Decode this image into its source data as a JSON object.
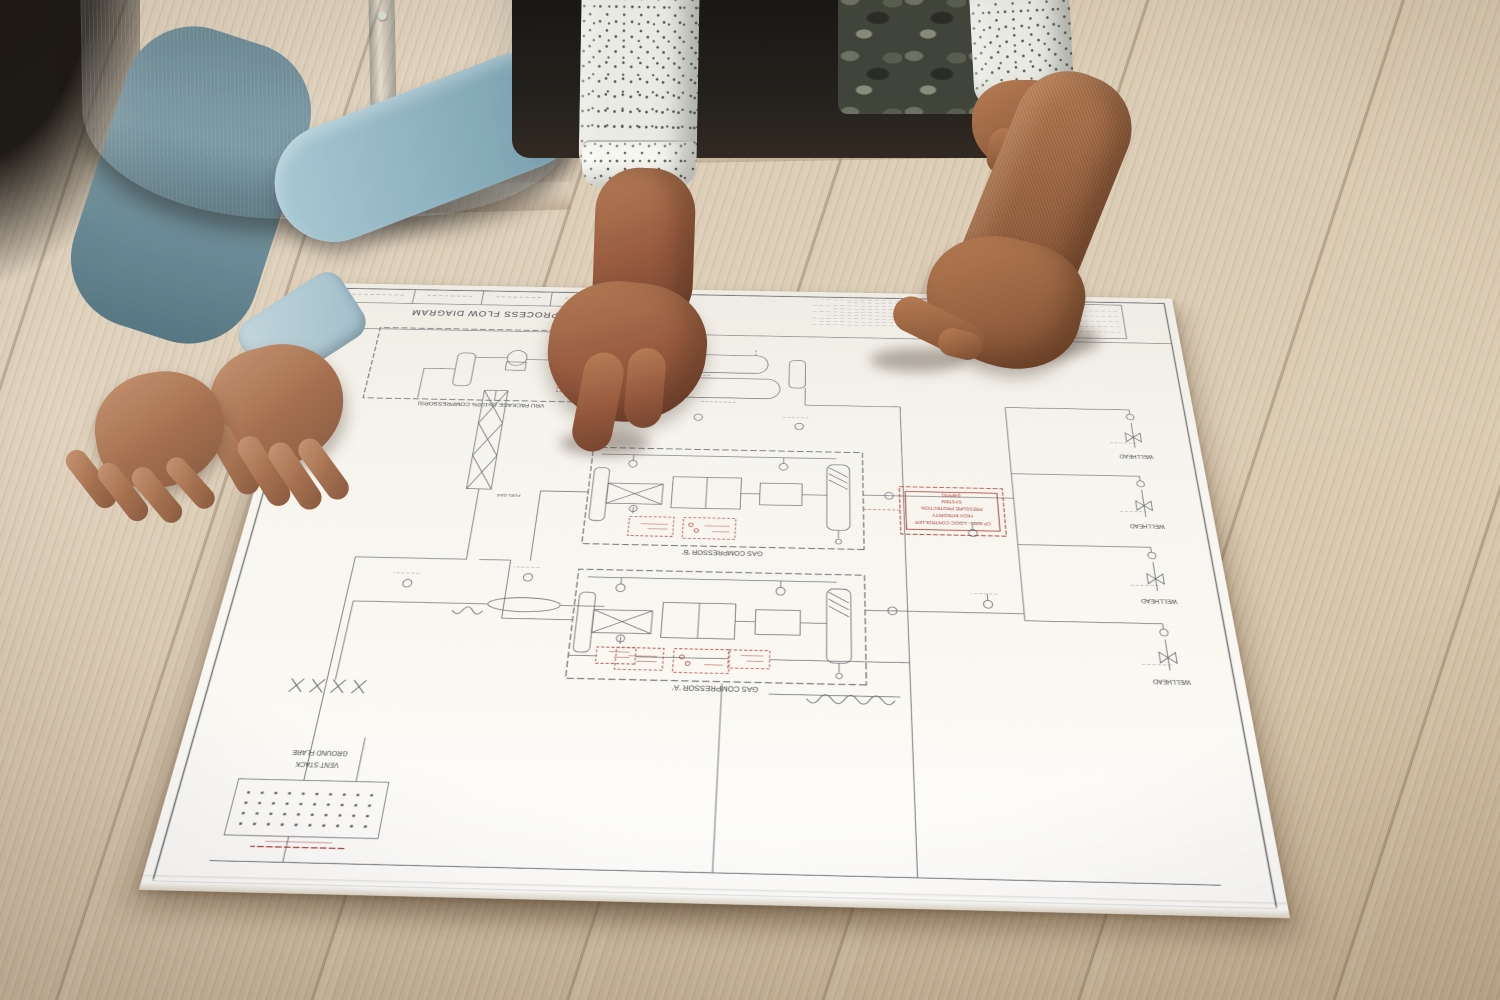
{
  "drawing": {
    "title_block": {
      "title": "OPAL PROCESS FLOW DIAGRAM",
      "notes_label": "NOTES"
    },
    "labels": {
      "vru_package": "VRU PACKAGE (2x100% COMPRESSORS)",
      "gas_compressor_a": "GAS COMPRESSOR 'A'",
      "gas_compressor_b": "GAS COMPRESSOR 'B'",
      "wellhead": "WELLHEAD",
      "vent_stack": "VENT STACK",
      "ground_flare": "GROUND FLARE",
      "fuel_gas": "FUEL GAS",
      "hipps": {
        "line1": "CP-9000 - LOGIC CONTROLLER",
        "line2": "HIGH INTEGRITY",
        "line3": "PRESSURE PROTECTION",
        "line4": "SYSTEM",
        "line5": "(HIPPS)"
      }
    }
  },
  "colors": {
    "wood": "#d4c5ac",
    "paper": "#f6f4ee",
    "line": "#5d6167",
    "highlight_red": "#a8322b",
    "shirt_blue": "#8fb5c3",
    "shirt_speckled": "#e9eae4",
    "clothing_dark": "#16130f"
  }
}
